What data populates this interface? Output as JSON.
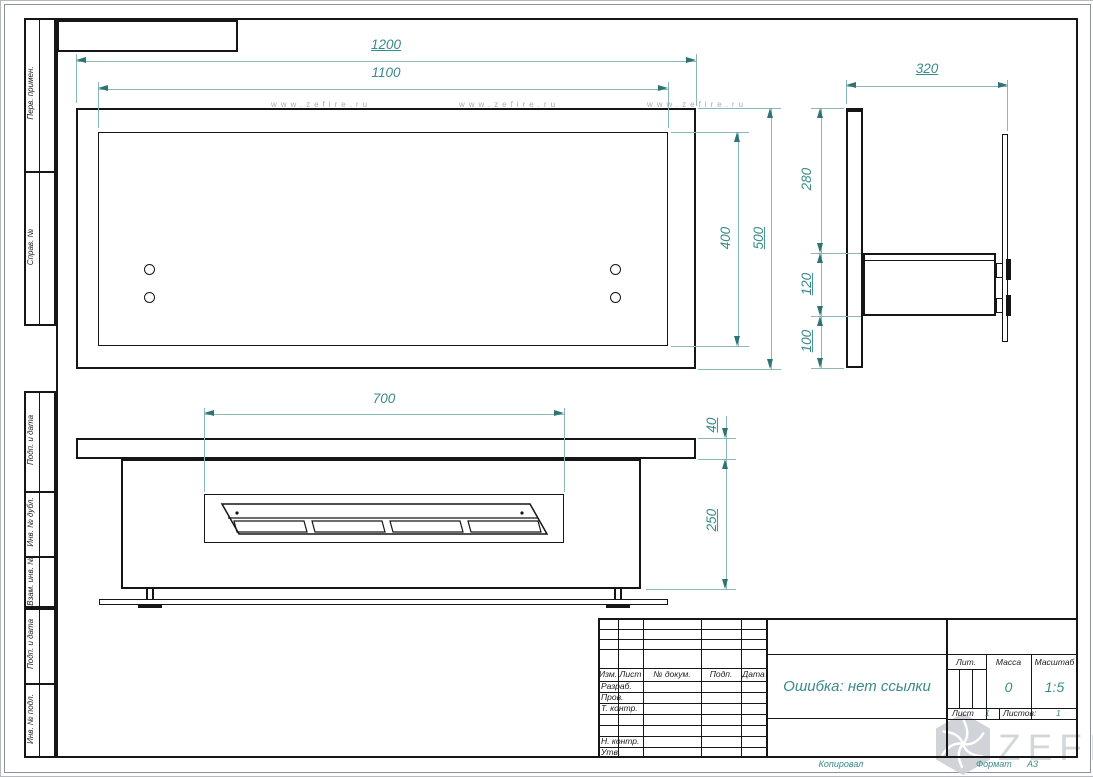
{
  "sheet": {
    "margin_labels": [
      "Перв. примен.",
      "Справ. №",
      "Подп. и дата",
      "Инв. № дубл.",
      "Взам. инв. №",
      "Подп. и дата",
      "Инв. № подл."
    ]
  },
  "watermark": {
    "site": "www.zefire.ru",
    "brand": "ZEFIRE"
  },
  "dimensions": {
    "front_outer_width": "1200",
    "front_inner_width": "1100",
    "front_inner_height": "400",
    "front_outer_height": "500",
    "side_depth": "320",
    "side_upper_height": "280",
    "side_body_height": "120",
    "side_lower_height": "100",
    "plan_insert_width": "700",
    "plan_shelf_thickness": "40",
    "plan_body_height": "250"
  },
  "title_block": {
    "rev_headers": [
      "Изм.",
      "Лист",
      "№ докум.",
      "Подп.",
      "Дата"
    ],
    "row_labels": [
      "Разраб.",
      "Пров.",
      "Т. контр.",
      "Н. контр.",
      "Утв."
    ],
    "doc_title": "Ошибка: нет ссылки",
    "lit_label": "Лит.",
    "mass_label": "Масса",
    "scale_label": "Масштаб",
    "mass_value": "0",
    "scale_value": "1:5",
    "sheet_label": "Лист",
    "sheet_value": "1",
    "sheets_label": "Листов:",
    "sheets_value": "1"
  },
  "footer": {
    "copied_by": "Копировал",
    "format_label": "Формат",
    "format_value": "А3"
  },
  "colors": {
    "dim_text": "#3a8a8a",
    "dim_line": "#8ab7b7",
    "drawing_line": "#161616",
    "watermark_gray": "#d3d7da"
  }
}
